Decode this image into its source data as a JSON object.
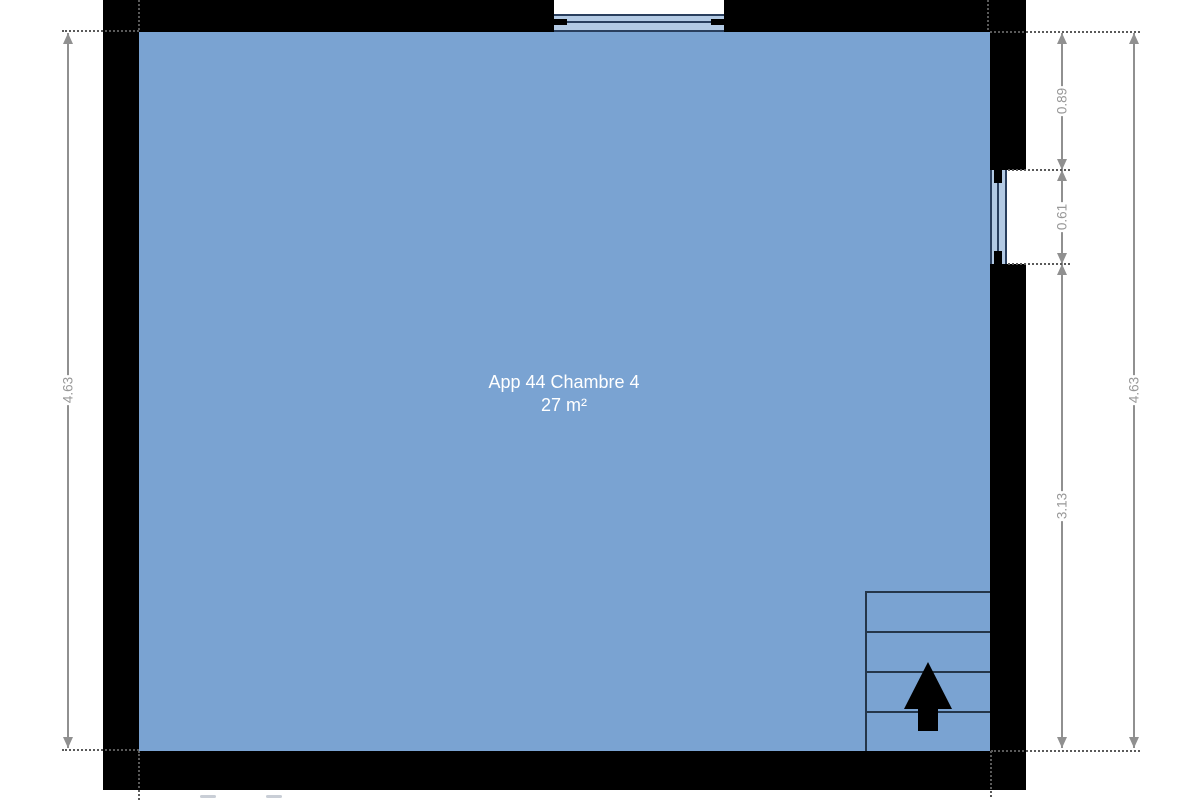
{
  "plan": {
    "room_label": "App 44 Chambre 4",
    "room_area": "27 m²",
    "dimensions": {
      "left_total": "4.63",
      "right_wall_to_window": "0.89",
      "right_window": "0.61",
      "right_window_to_wall": "3.13",
      "right_total": "4.63"
    }
  },
  "icons": {
    "stairs_direction_icon": "up-arrow"
  },
  "colors": {
    "room_fill": "#7aa3d2",
    "wall": "#000000",
    "window_glass": "#b3cae4",
    "window_frame": "#2a3f5e",
    "dimension_gray": "#909090",
    "stair_line": "#24364a",
    "room_text": "#ffffff",
    "background": "#ffffff"
  }
}
